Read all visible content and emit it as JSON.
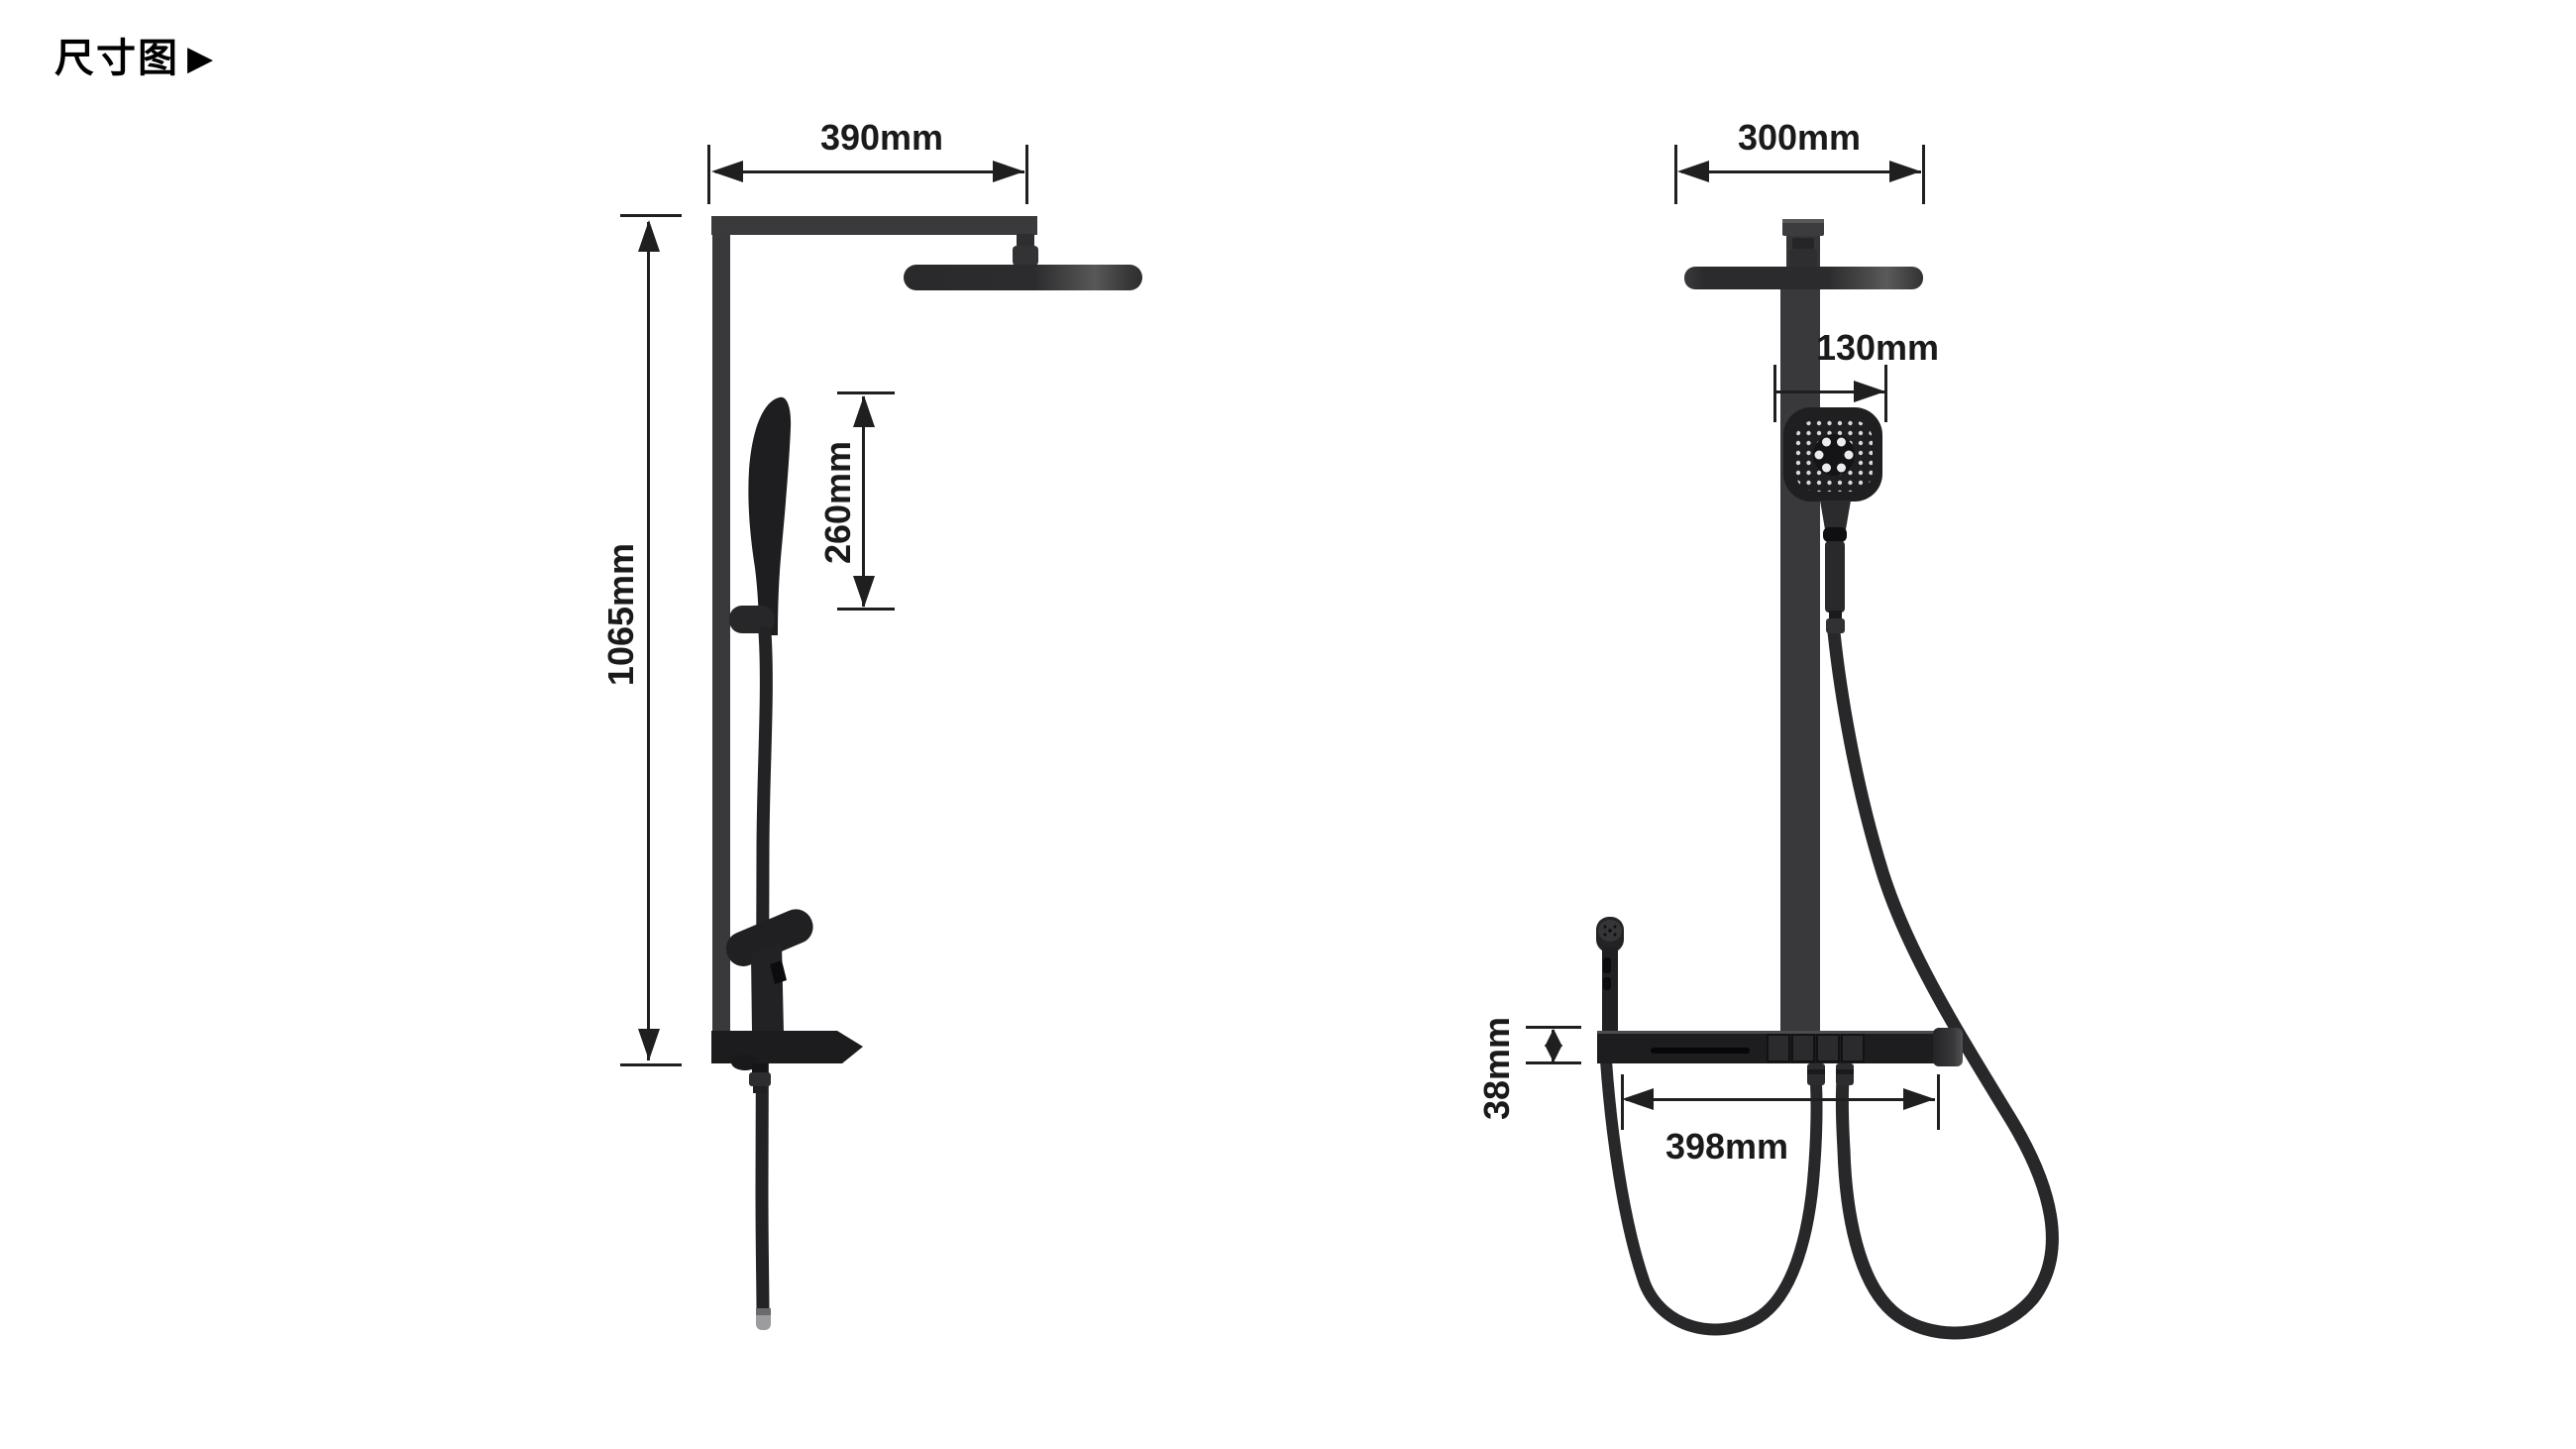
{
  "title": {
    "text": "尺寸图",
    "marker": "▶"
  },
  "colors": {
    "background": "#ffffff",
    "ink": "#1f1f1f",
    "fixture_gray": "#39393b",
    "fixture_dark": "#1d1d1f"
  },
  "side_view": {
    "label_arm_width": "390mm",
    "label_total_height": "1065mm",
    "label_hand_shower_length": "260mm"
  },
  "front_view": {
    "label_head_width": "300mm",
    "label_hand_shower_width": "130mm",
    "label_shelf_thickness": "38mm",
    "label_shelf_width": "398mm"
  }
}
